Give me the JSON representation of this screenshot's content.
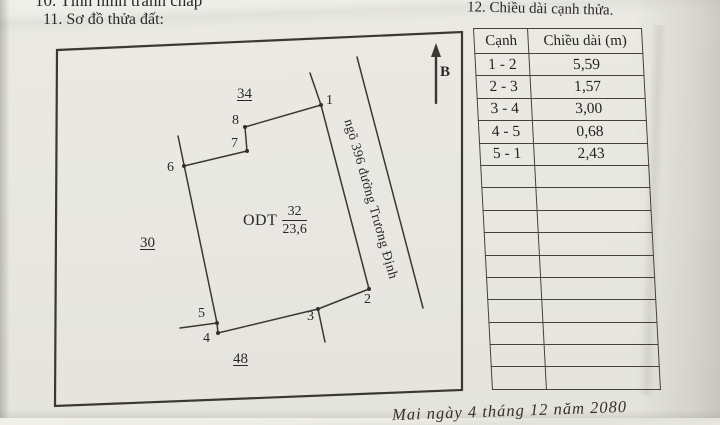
{
  "page": {
    "field_10_label": "10. Tình hình tranh chấp",
    "field_11_label": "11. Sơ đồ thửa đất:",
    "field_12_label": "12. Chiều dài cạnh thửa.",
    "footer_note": "Mai ngày 4 tháng 12 năm 2080"
  },
  "diagram": {
    "north_label": "B",
    "street_label": "ngõ 396 đường Trương Định",
    "plot_type": "ODT",
    "plot_number": "32",
    "plot_area": "23,6",
    "adjacent_plot_labels": {
      "top": "34",
      "left": "30",
      "bottom": "48"
    },
    "vertex_labels": [
      "1",
      "2",
      "3",
      "4",
      "5",
      "6",
      "7",
      "8"
    ]
  },
  "table": {
    "headers": [
      "Cạnh",
      "Chiều dài (m)"
    ],
    "rows": [
      {
        "side": "1 - 2",
        "length": "5,59"
      },
      {
        "side": "2 - 3",
        "length": "1,57"
      },
      {
        "side": "3 - 4",
        "length": "3,00"
      },
      {
        "side": "4 - 5",
        "length": "0,68"
      },
      {
        "side": "5 - 1",
        "length": "2,43"
      }
    ],
    "empty_row_count": 10
  },
  "colors": {
    "paper": "#e8e7e1",
    "ink": "#2b2925",
    "line": "#45423b"
  }
}
